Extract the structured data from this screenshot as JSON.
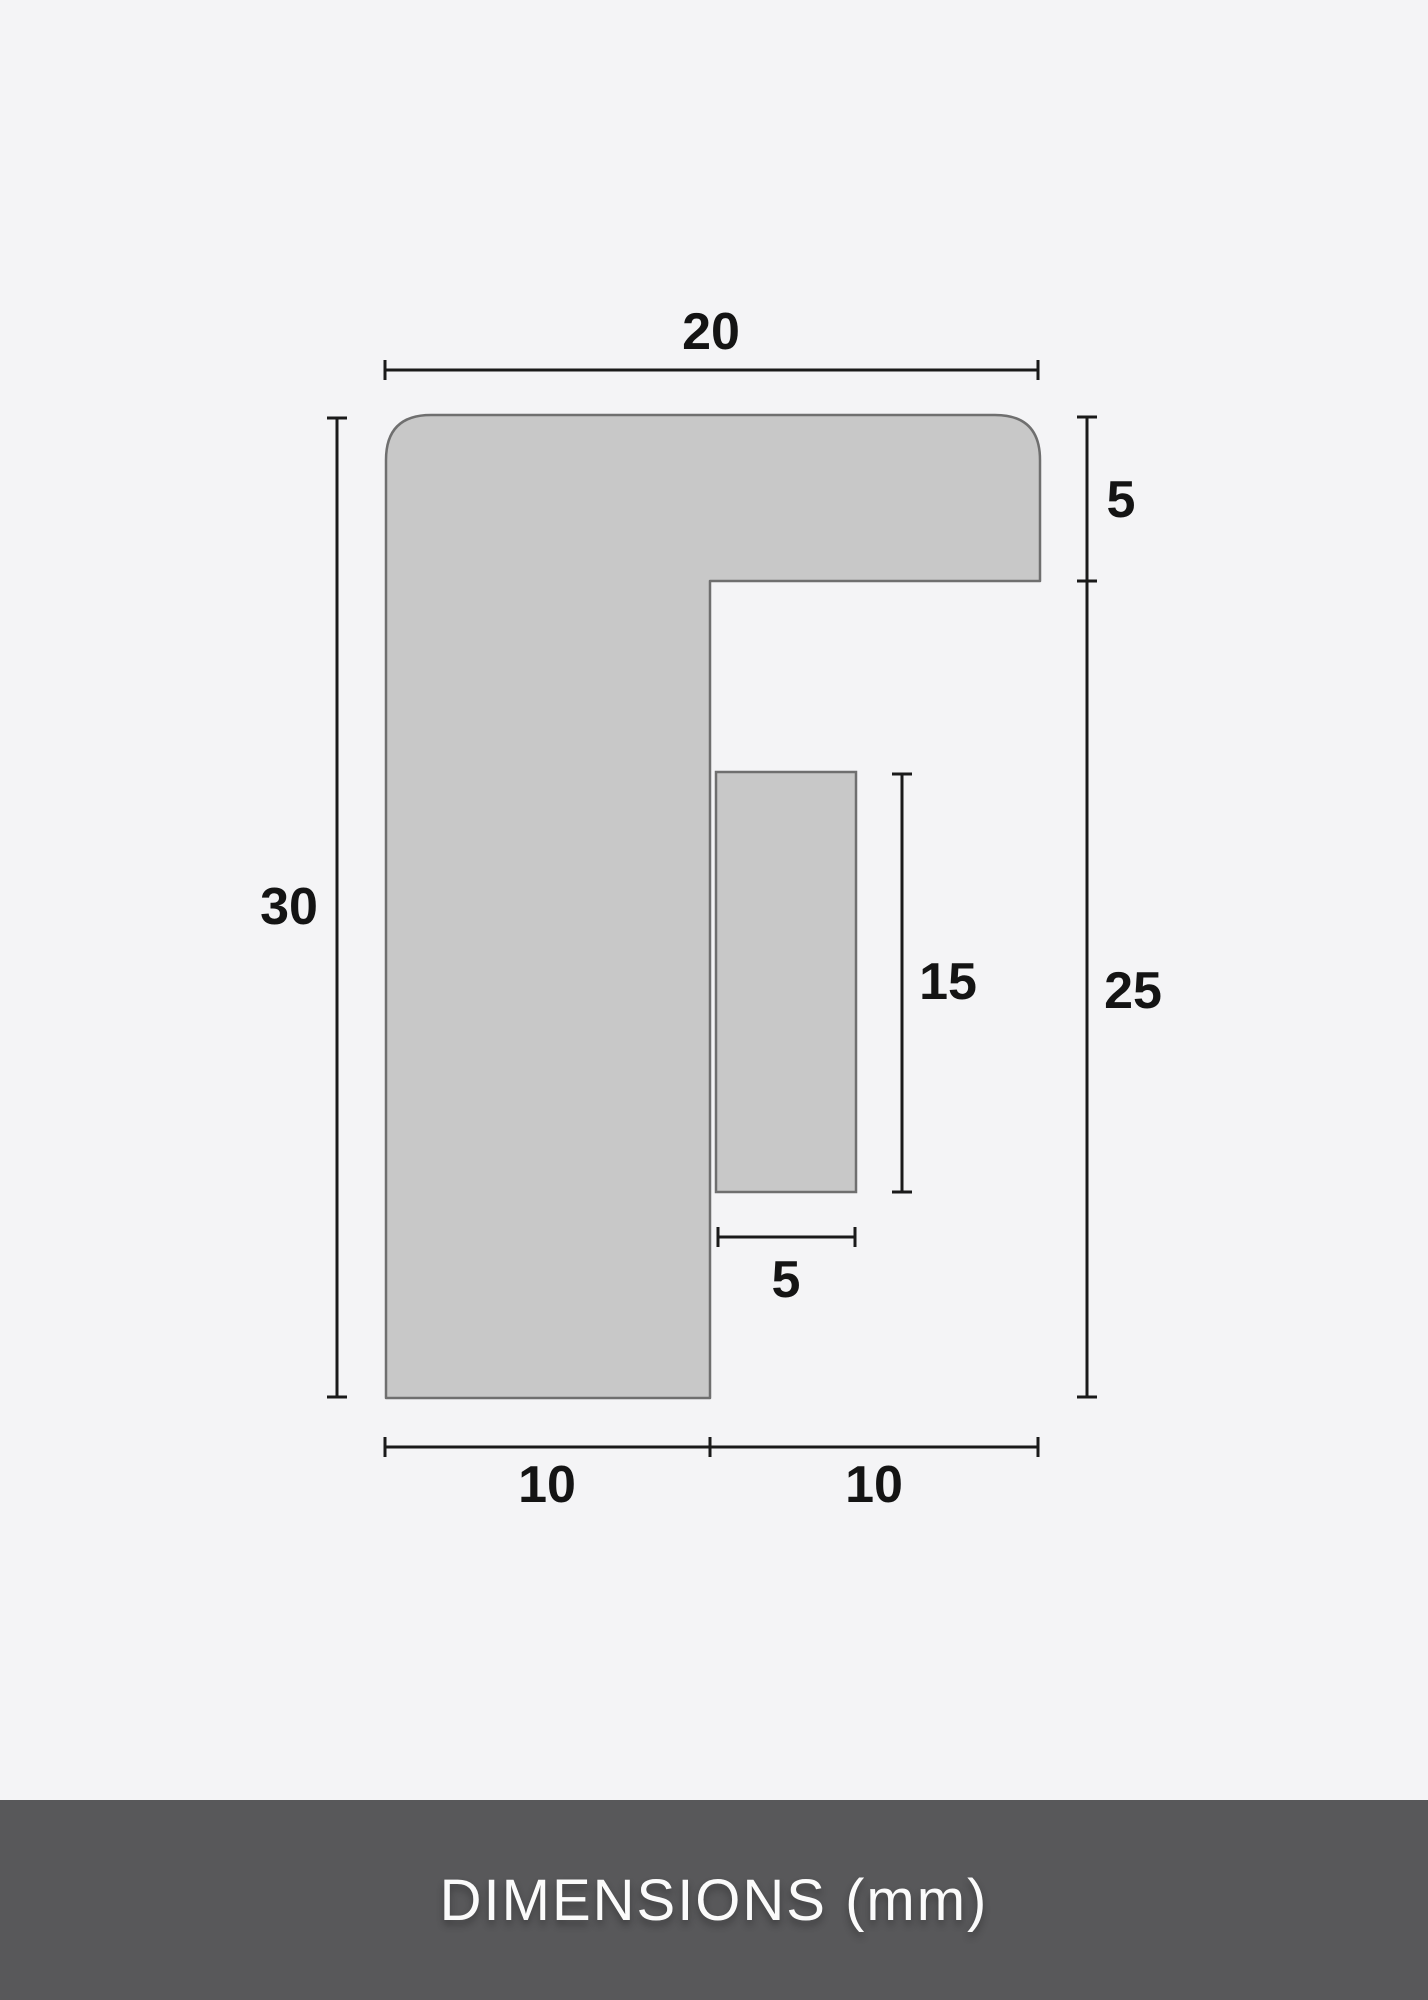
{
  "diagram": {
    "labels": {
      "top_width": "20",
      "upper_right_height": "5",
      "left_height": "30",
      "inner_height": "15",
      "lower_right_height": "25",
      "inner_width": "5",
      "bottom_left_width": "10",
      "bottom_right_width": "10"
    },
    "colors": {
      "background": "#f4f4f6",
      "shape_fill": "#c8c8c8",
      "shape_stroke": "#6f6f6f",
      "dimension_line": "#1a1a1a",
      "label_text": "#141414",
      "footer_background": "#58585a",
      "footer_text": "#fbfbfb"
    }
  },
  "footer": {
    "title": "DIMENSIONS (mm)"
  }
}
